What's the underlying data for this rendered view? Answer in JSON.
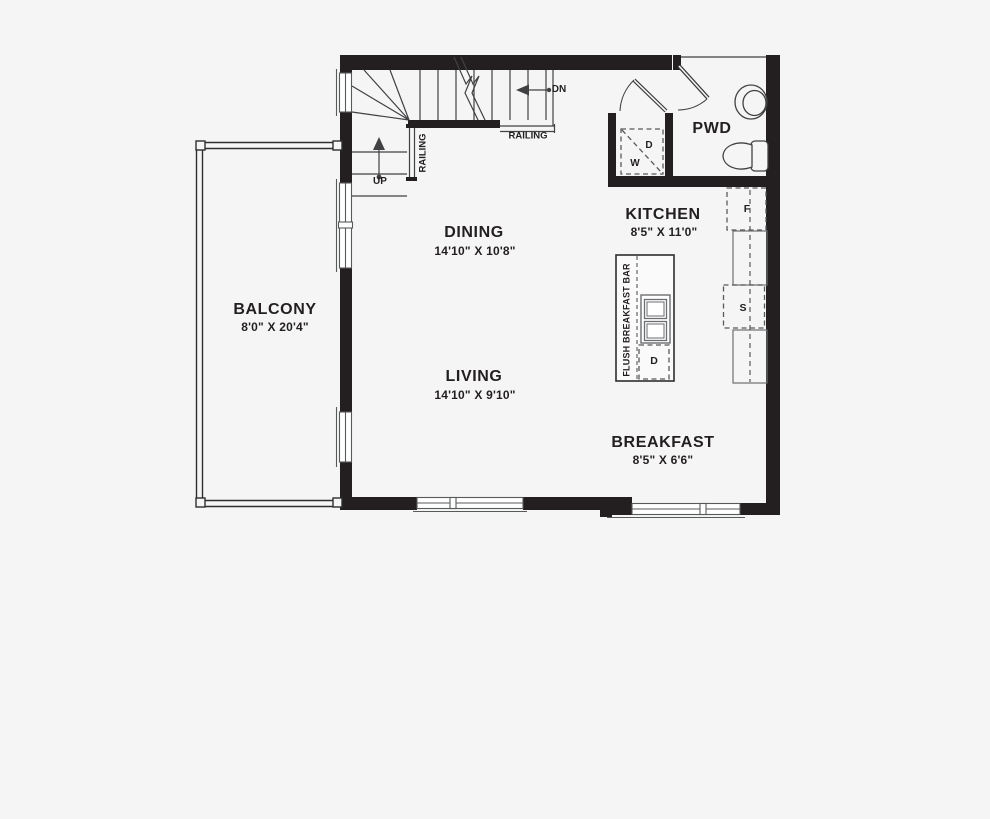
{
  "plan": {
    "title": "Floor plan - main level",
    "rooms": [
      {
        "name": "BALCONY",
        "dims": "8'0\" X 20'4\""
      },
      {
        "name": "DINING",
        "dims": "14'10\" X 10'8\""
      },
      {
        "name": "LIVING",
        "dims": "14'10\" X 9'10\""
      },
      {
        "name": "KITCHEN",
        "dims": "8'5\" X 11'0\""
      },
      {
        "name": "BREAKFAST",
        "dims": "8'5\" X 6'6\""
      },
      {
        "name": "PWD",
        "dims": ""
      }
    ],
    "annotations": {
      "up": "UP",
      "dn": "DN",
      "railing_vertical": "RAILING",
      "railing_horizontal": "RAILING",
      "flush_bar": "FLUSH BREAKFAST BAR"
    },
    "appliances": {
      "fridge": "F",
      "sink": "S",
      "dishwasher_island": "D",
      "dryer_closet": "D",
      "washer_closet": "W"
    },
    "colors": {
      "wall": "#231f20",
      "line": "#414042",
      "background": "#f5f5f6",
      "text": "#231f20"
    }
  }
}
